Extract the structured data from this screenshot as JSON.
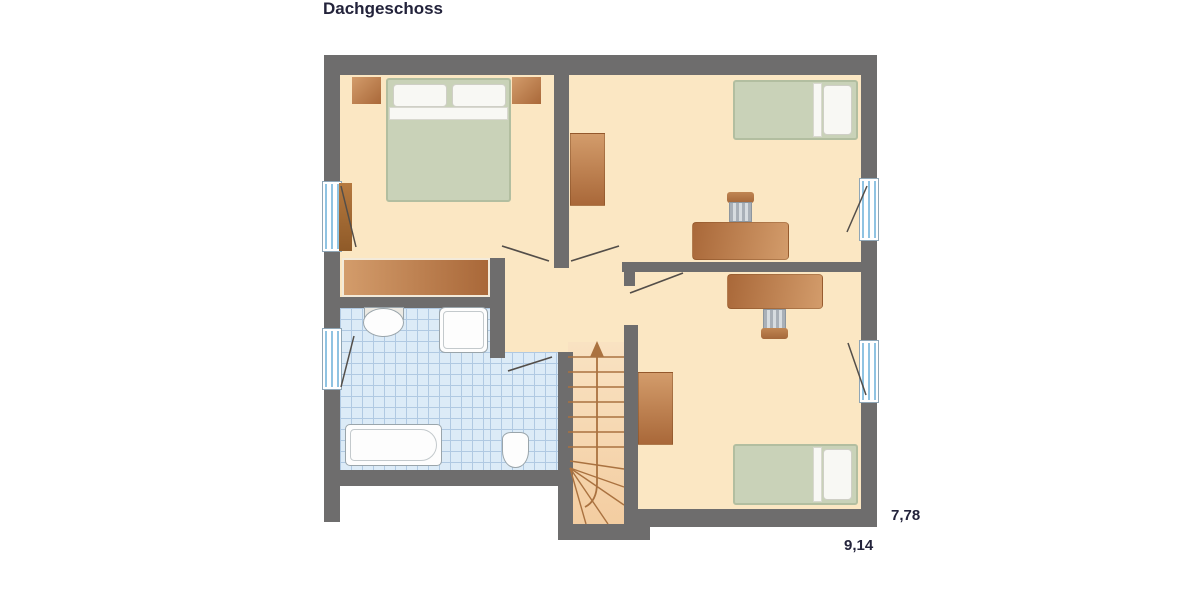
{
  "title": "Dachgeschoss",
  "dimensions": {
    "height_label": "7,78",
    "width_label": "9,14"
  },
  "colors": {
    "wall": "#6e6d6d",
    "floor": "#fbe7c3",
    "tile": "#dcebf7",
    "tile_line": "#b0c9e2",
    "stair_light": "#f9e2c2",
    "stair_dark": "#f3cda1",
    "stair_line": "#aa7240",
    "bed_green": "#c9d2b8",
    "bed_frame": "#b2bea0",
    "pillow": "#f8f8f4",
    "brown_light": "#d39c6b",
    "brown_dark": "#a96839",
    "swing": "#534e49",
    "sanitary_border": "#9aa5ab",
    "text": "#23233b"
  },
  "floor_plan": {
    "floor_name": "Dachgeschoss",
    "rooms": [
      {
        "id": "bedroom-top-left",
        "furniture": [
          "double-bed",
          "nightstand-left",
          "nightstand-right",
          "dresser",
          "window-left"
        ]
      },
      {
        "id": "bedroom-top-right",
        "furniture": [
          "single-bed",
          "wardrobe",
          "desk",
          "chair",
          "window-right"
        ]
      },
      {
        "id": "bedroom-bottom-right",
        "furniture": [
          "single-bed",
          "wardrobe",
          "desk",
          "chair",
          "window-right"
        ]
      },
      {
        "id": "bathroom",
        "furniture": [
          "sink",
          "shower",
          "bathtub",
          "toilet",
          "window-left"
        ]
      },
      {
        "id": "hallway",
        "furniture": []
      },
      {
        "id": "staircase",
        "furniture": [
          "stairs-up-arrow"
        ]
      }
    ],
    "window_count": 4,
    "door_count": 4
  }
}
